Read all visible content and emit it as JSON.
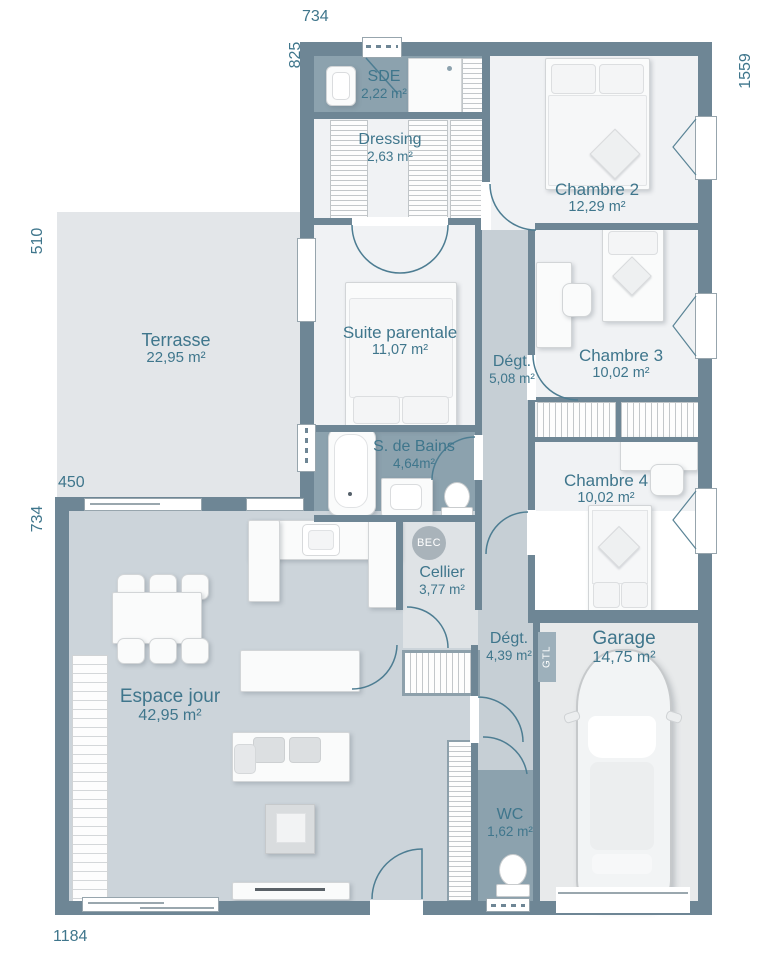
{
  "plan": {
    "rooms": [
      {
        "name": "Terrasse",
        "area": "22,95 m²"
      },
      {
        "name": "SDE",
        "area": "2,22 m²"
      },
      {
        "name": "Dressing",
        "area": "2,63 m²"
      },
      {
        "name": "Chambre 2",
        "area": "12,29 m²"
      },
      {
        "name": "Suite parentale",
        "area": "11,07 m²"
      },
      {
        "name": "Dégt.",
        "area": "5,08 m²"
      },
      {
        "name": "Chambre 3",
        "area": "10,02 m²"
      },
      {
        "name": "S. de Bains",
        "area": "4,64m²"
      },
      {
        "name": "Chambre 4",
        "area": "10,02 m²"
      },
      {
        "name": "Cellier",
        "area": "3,77 m²"
      },
      {
        "name": "Espace jour",
        "area": "42,95 m²"
      },
      {
        "name": "Dégt.",
        "area": "4,39 m²"
      },
      {
        "name": "Garage",
        "area": "14,75 m²"
      },
      {
        "name": "WC",
        "area": "1,62 m²"
      }
    ],
    "dimensions_cm": {
      "top": "734",
      "upper_left": "825",
      "right": "1559",
      "terrace_left": "510",
      "terrace_width": "450",
      "lower_left": "734",
      "bottom": "1184"
    },
    "badges": {
      "bec": "BEC",
      "gtl": "GTL"
    },
    "colors": {
      "wall": "#6e8695",
      "label_text": "#3f768c",
      "wet_room": "#8ca2ae",
      "corridor": "#c6cfd5",
      "living": "#ccd4da",
      "terrace": "#e3e6e9",
      "bedroom": "#f0f2f4",
      "cellier": "#dfe3e6",
      "garage": "#e8eaeb"
    }
  }
}
